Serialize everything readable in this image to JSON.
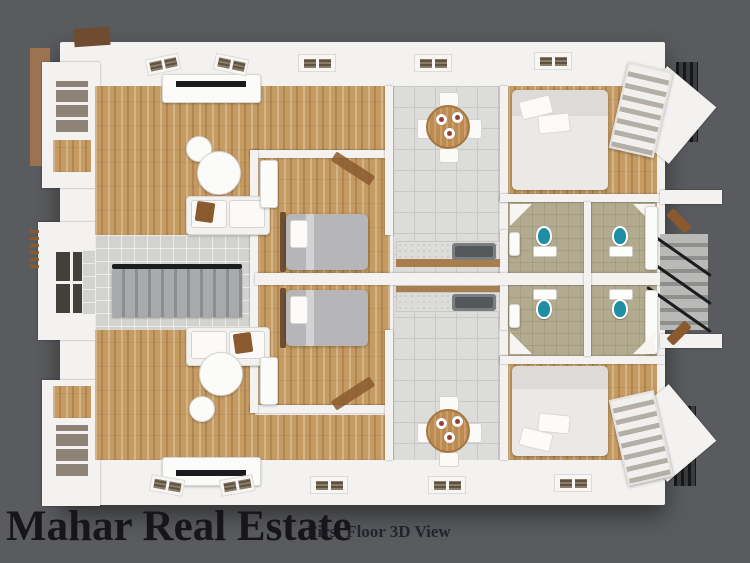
{
  "overlay": {
    "watermark": "Mahar Real Estate",
    "caption": "First Floor 3D View"
  },
  "colors": {
    "bg": "#595b5e",
    "wall": "#f3f2f0",
    "wood": "#c69b62",
    "tile": "#dcdcda",
    "tile_line": "#c8c8c6",
    "lobby_tile": "#d2d3d1",
    "bath_floor": "#b3ab8f",
    "toilet": "#1f8da4",
    "bed_gray": "#b6b5b7",
    "bed_white": "#ebe9e5",
    "table_wood": "#bd8a50",
    "counter_wood": "#a87e4e",
    "stair_rail": "#1b1c1e",
    "grill": "#3a3b3e",
    "brown": "#8a5a2e",
    "tan_wall": "#9c7351",
    "glass_dark": "#433f3a",
    "sink": "#7b7e81",
    "text": "#15151a",
    "caption_text": "#23232c"
  }
}
